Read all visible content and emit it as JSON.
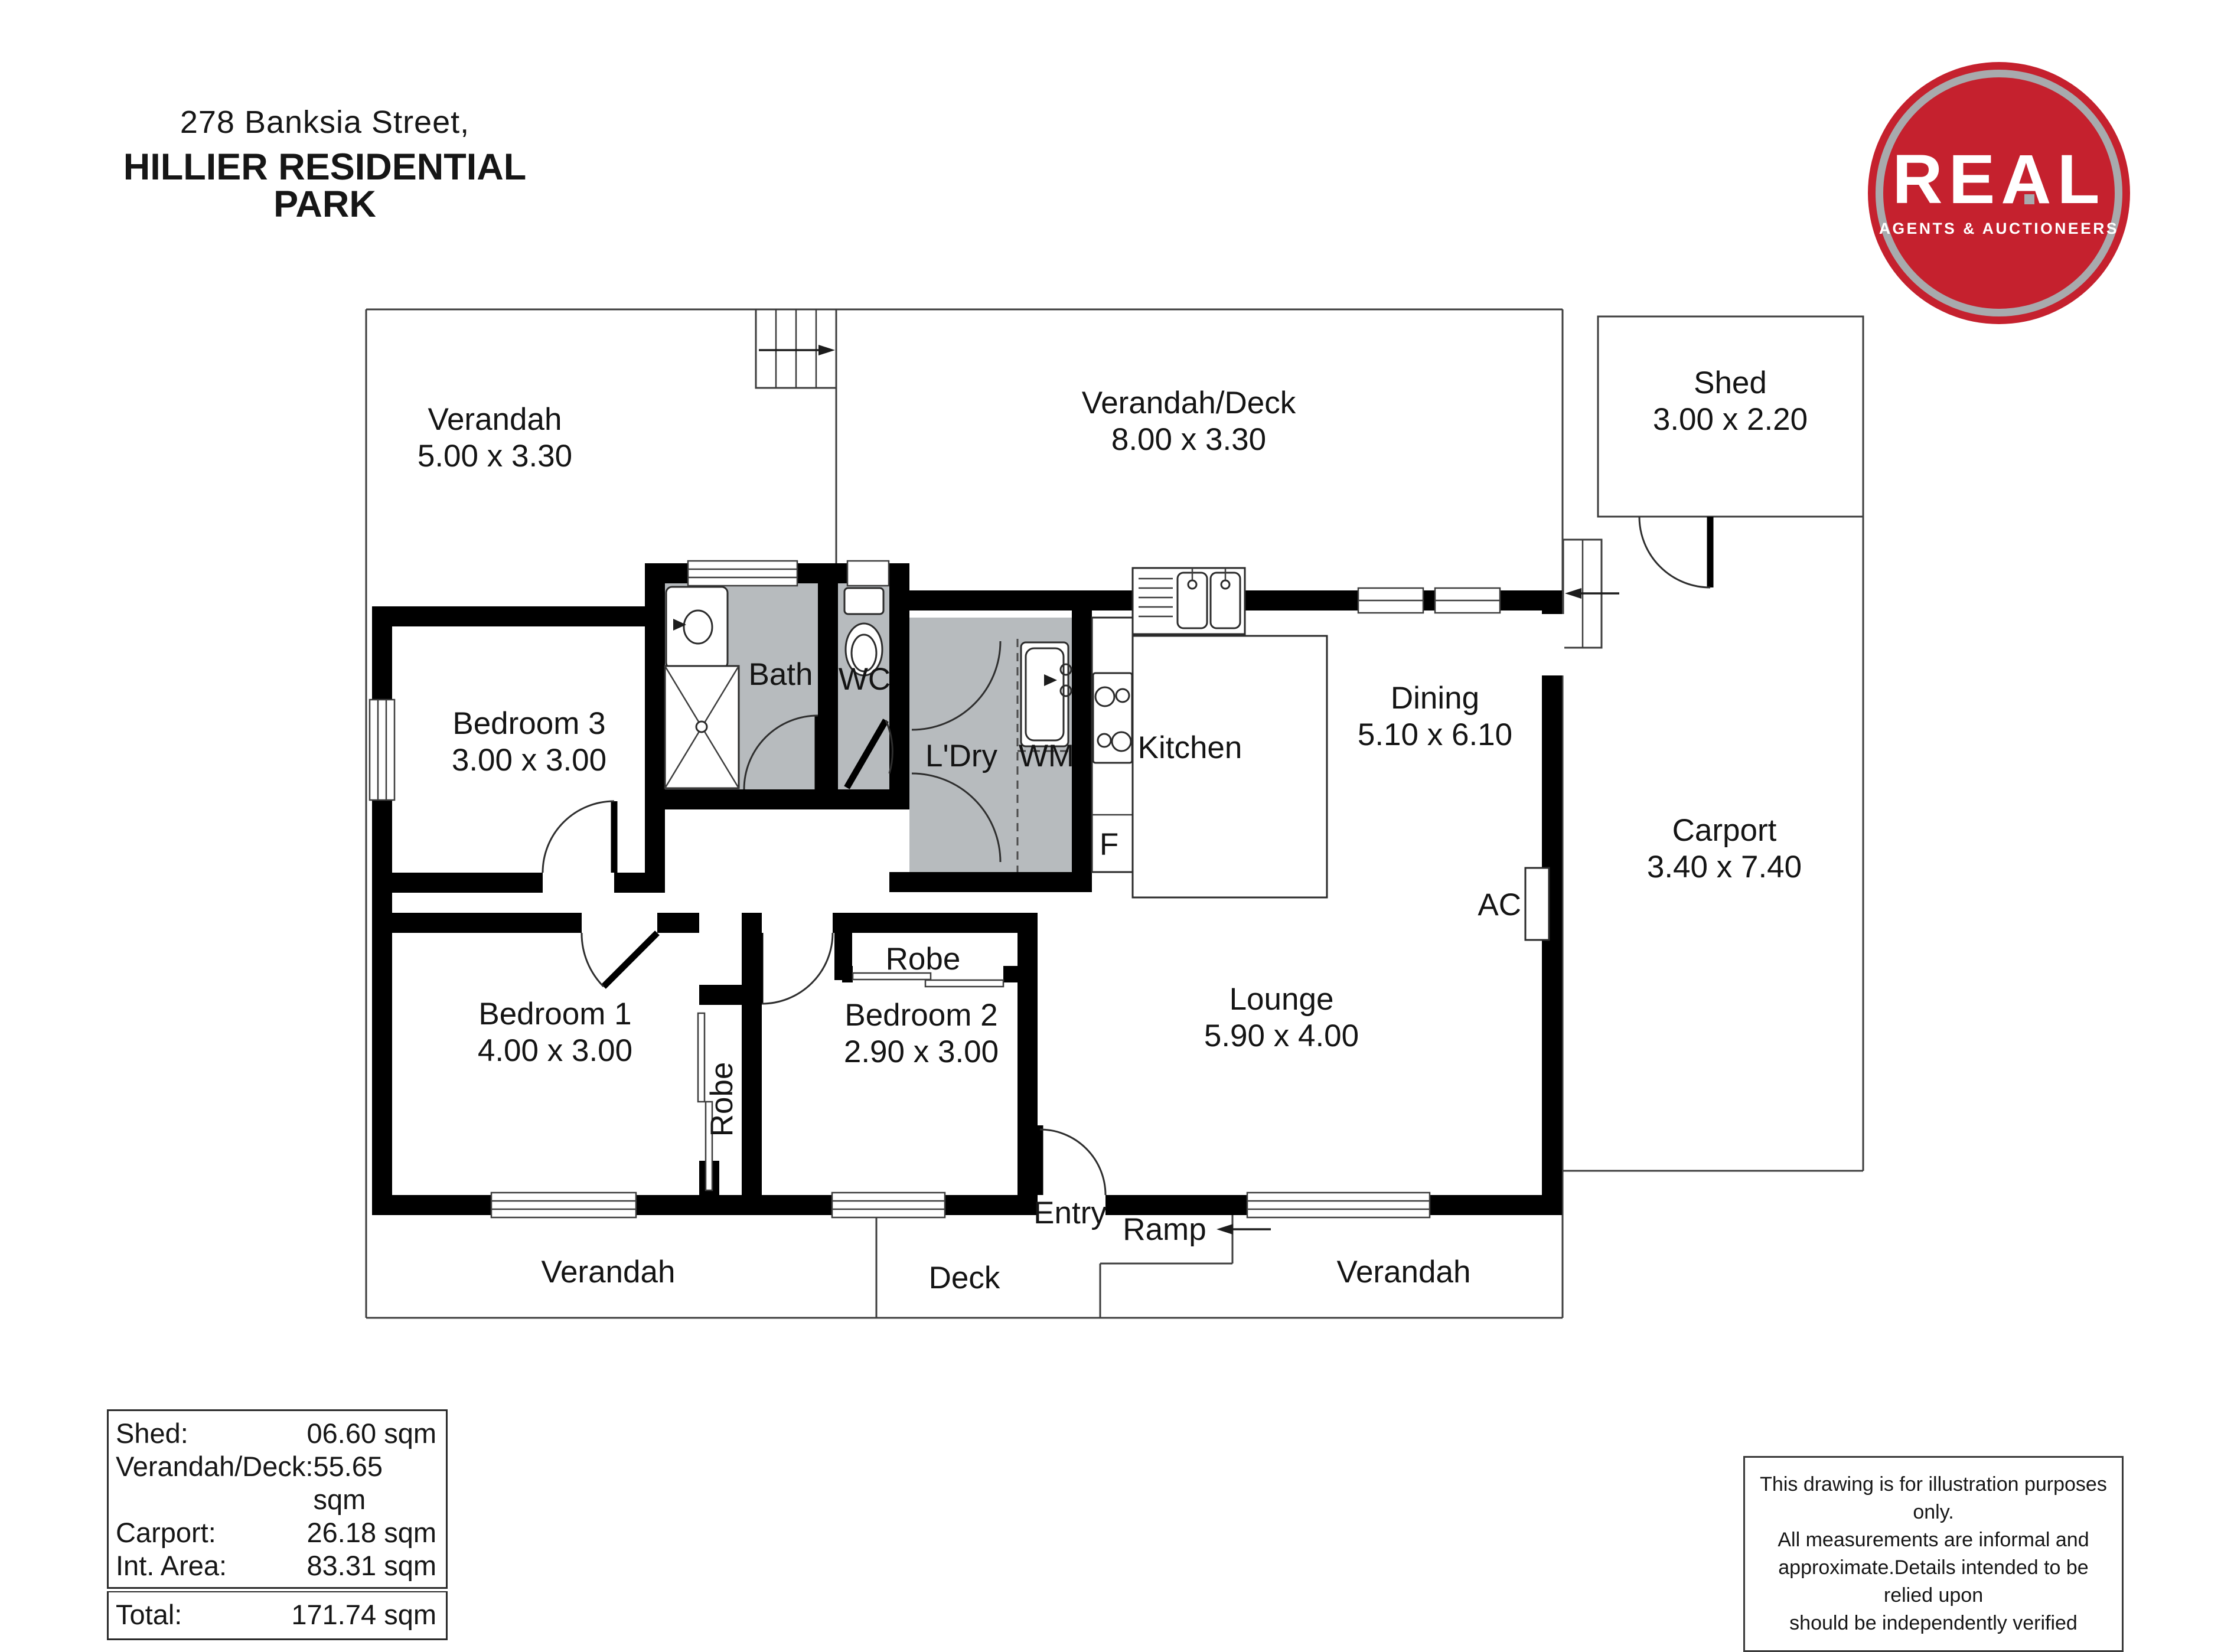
{
  "title": {
    "address_line": "278 Banksia Street,",
    "park_line": "HILLIER RESIDENTIAL PARK"
  },
  "logo": {
    "brand": "REAL",
    "tagline": "AGENTS & AUCTIONEERS",
    "bg_color": "#c5212e",
    "ring_color": "#a8aaad"
  },
  "plan": {
    "room_gray_color": "#b7bbbe",
    "verandah_tl": {
      "name": "Verandah",
      "dims": "5.00 x 3.30"
    },
    "verandah_deck": {
      "name": "Verandah/Deck",
      "dims": "8.00 x 3.30"
    },
    "shed": {
      "name": "Shed",
      "dims": "3.00 x 2.20"
    },
    "carport": {
      "name": "Carport",
      "dims": "3.40 x 7.40"
    },
    "bedroom3": {
      "name": "Bedroom 3",
      "dims": "3.00 x 3.00"
    },
    "bedroom1": {
      "name": "Bedroom 1",
      "dims": "4.00 x 3.00"
    },
    "bedroom2": {
      "name": "Bedroom 2",
      "dims": "2.90 x 3.00"
    },
    "lounge": {
      "name": "Lounge",
      "dims": "5.90 x 4.00"
    },
    "dining": {
      "name": "Dining",
      "dims": "5.10 x 6.10"
    },
    "kitchen": {
      "name": "Kitchen"
    },
    "bath": {
      "name": "Bath"
    },
    "wc": {
      "name": "WC"
    },
    "ldry": {
      "name": "L'Dry"
    },
    "wm": {
      "name": "WM"
    },
    "fridge": {
      "name": "F"
    },
    "ac": {
      "name": "AC"
    },
    "robe1": {
      "name": "Robe"
    },
    "robe2": {
      "name": "Robe"
    },
    "entry": {
      "name": "Entry"
    },
    "ramp": {
      "name": "Ramp"
    },
    "verandah_bl": {
      "name": "Verandah"
    },
    "deck": {
      "name": "Deck"
    },
    "verandah_br": {
      "name": "Verandah"
    }
  },
  "areas": {
    "rows": [
      {
        "label": "Shed:",
        "value": "06.60 sqm"
      },
      {
        "label": "Verandah/Deck:",
        "value": "55.65 sqm"
      },
      {
        "label": "Carport:",
        "value": "26.18 sqm"
      },
      {
        "label": "Int. Area:",
        "value": "83.31 sqm"
      }
    ],
    "total": {
      "label": "Total:",
      "value": "171.74 sqm"
    }
  },
  "disclaimer": {
    "lines": [
      "This drawing is for illustration purposes only.",
      "All measurements are informal and",
      "approximate.Details intended to be relied upon",
      "should be independently verified"
    ]
  }
}
